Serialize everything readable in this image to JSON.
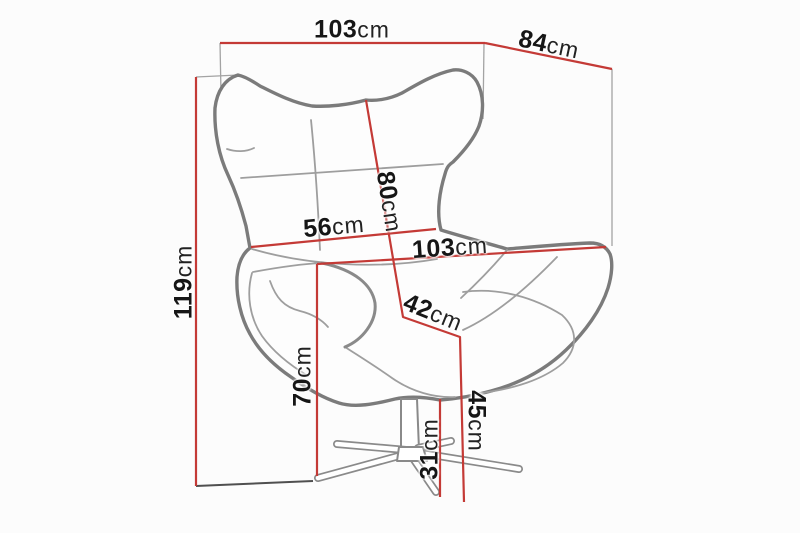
{
  "figure": {
    "type": "furniture-dimension-diagram",
    "subject": "wing-back swivel egg chair with star base",
    "unit": "cm",
    "colors": {
      "dimension_line": "#c43a36",
      "chair_outline": "#7b7b7b",
      "seam_line": "#9e9e9e",
      "construction_line": "#a3a3a3",
      "label_text": "#161616",
      "background": "#fcfcfc"
    },
    "dimensions": {
      "overall_width": {
        "value": "103",
        "unit": "cm"
      },
      "depth": {
        "value": "84",
        "unit": "cm"
      },
      "backrest_height": {
        "value": "80",
        "unit": "cm"
      },
      "backrest_width": {
        "value": "56",
        "unit": "cm"
      },
      "seat_width": {
        "value": "103",
        "unit": "cm"
      },
      "seat_depth": {
        "value": "42",
        "unit": "cm"
      },
      "overall_height": {
        "value": "119",
        "unit": "cm"
      },
      "armrest_height": {
        "value": "70",
        "unit": "cm"
      },
      "seat_height": {
        "value": "45",
        "unit": "cm"
      },
      "base_height": {
        "value": "31",
        "unit": "cm"
      }
    }
  }
}
